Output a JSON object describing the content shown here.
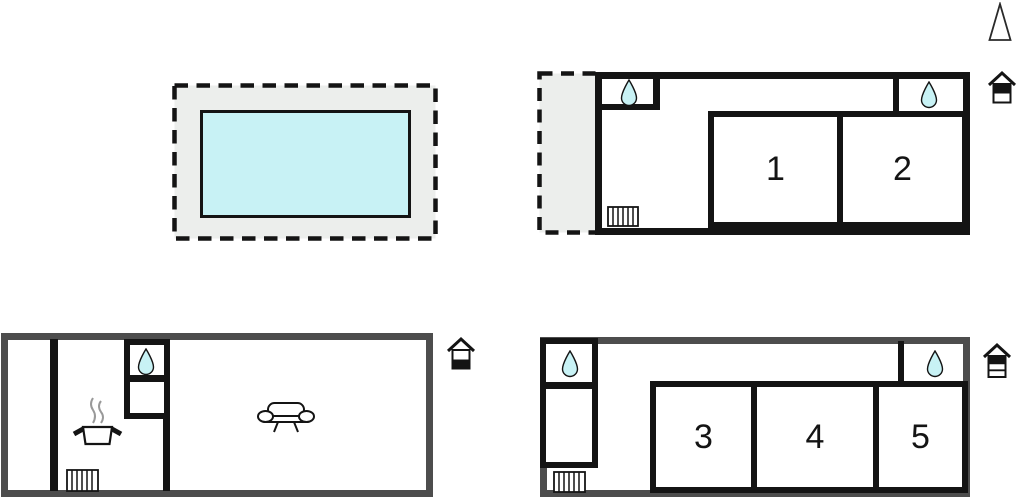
{
  "diagram": {
    "type": "floor-plan",
    "colors": {
      "wall_black": "#141414",
      "wall_gray": "#4d4d4d",
      "terrace_fill": "#eceeec",
      "water_fill": "#c8f2f5",
      "steam_gray": "#999999"
    },
    "pool": {
      "name": "swimming-pool",
      "surround": "terrace-dashed-outline"
    },
    "compass": {
      "name": "north-arrow"
    },
    "plans": {
      "upper_floor": {
        "house_icon": "house-two-levels-top-filled",
        "rooms": [
          {
            "number": "1"
          },
          {
            "number": "2"
          }
        ],
        "features": [
          "terrace-dashed",
          "bathroom-drop",
          "bathroom-drop",
          "radiator"
        ]
      },
      "ground_floor": {
        "house_icon": "house-two-levels-bottom-filled",
        "rooms": [],
        "features": [
          "bathroom-drop",
          "stove-pot",
          "sofa",
          "radiator"
        ]
      },
      "annex_floor": {
        "house_icon": "house-three-levels-top-filled",
        "rooms": [
          {
            "number": "3"
          },
          {
            "number": "4"
          },
          {
            "number": "5"
          }
        ],
        "features": [
          "bathroom-drop",
          "bathroom-drop",
          "radiator"
        ]
      }
    }
  }
}
